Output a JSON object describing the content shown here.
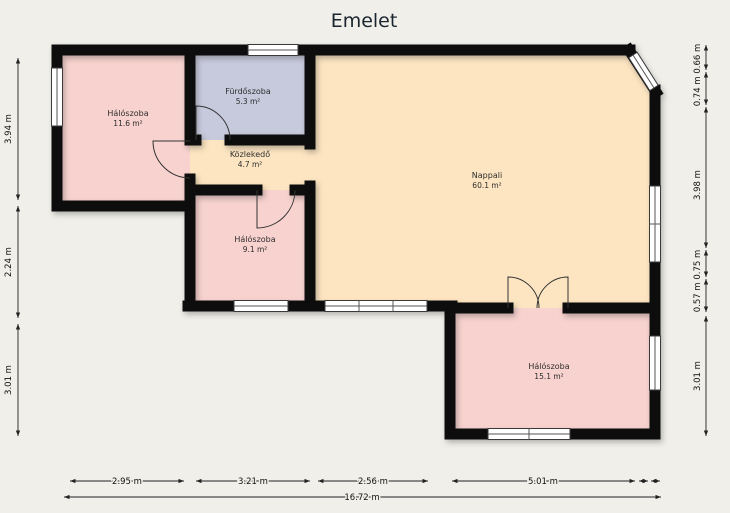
{
  "title": "Emelet",
  "rooms": {
    "bedroom_top_left": {
      "name": "Hálószoba",
      "area": "11.6 m²"
    },
    "bathroom": {
      "name": "Fürdőszoba",
      "area": "5.3 m²"
    },
    "hallway": {
      "name": "Közlekedő",
      "area": "4.7 m²"
    },
    "bedroom_middle": {
      "name": "Hálószoba",
      "area": "9.1 m²"
    },
    "living_room": {
      "name": "Nappali",
      "area": "60.1 m²"
    },
    "bedroom_bottom_right": {
      "name": "Hálószoba",
      "area": "15.1 m²"
    }
  },
  "dimensions": {
    "left_top": "3.94 m",
    "left_middle": "2.24 m",
    "left_bottom": "3.01 m",
    "right_top": "0.74 m 0.66 m",
    "right_middle": "3.98 m",
    "right_lower": "0.57 m 0.75 m",
    "right_bottom": "3.01 m",
    "bottom_1": "2.95 m",
    "bottom_2": "3.21 m",
    "bottom_3": "2.56 m",
    "bottom_4": "5.01 m",
    "total_width": "16.72 m"
  },
  "colors": {
    "background": "#f0efe9",
    "bedroom": "#f8d2ce",
    "bathroom": "#c7c9dc",
    "living": "#fde5c1",
    "hallway": "#fde5c1",
    "wall": "#0d0d0d",
    "window": "#ffffff",
    "dimension": "#222222"
  }
}
